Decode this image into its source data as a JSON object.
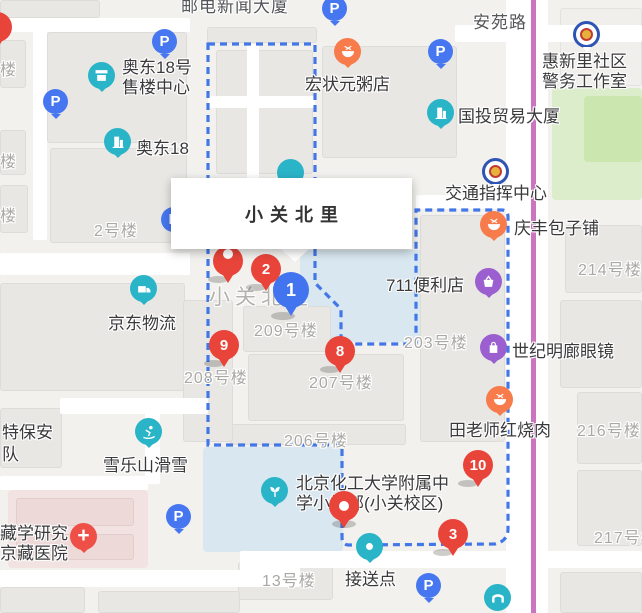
{
  "colors": {
    "marker_red": "#e8443a",
    "marker_blue": "#4374f0",
    "poi_teal": "#2ab4c8",
    "poi_orange": "#f87b4c",
    "poi_purple": "#9b5fd0",
    "parking_blue": "#4677f0",
    "boundary_blue": "#4377e8",
    "transit_magenta": "#cb74bf",
    "park_green": "#dcedcc",
    "school_blue": "#d9e7f0",
    "hospital_pink": "#f2e3e2"
  },
  "title_box": {
    "text": "小关北里"
  },
  "map_underlay_label": "小关北里",
  "road_labels": [
    "安苑路"
  ],
  "building_labels": [
    "邮电新闻大厦",
    "2号楼",
    "209号楼",
    "208号楼",
    "207号楼",
    "206号楼",
    "203号楼",
    "214号楼",
    "216号楼",
    "217号楼",
    "13号楼",
    "楼",
    "楼",
    "楼",
    "特保安",
    "队"
  ],
  "parking": {
    "letter": "P"
  },
  "markers": [
    {
      "number": "1",
      "color": "blue"
    },
    {
      "number": "2",
      "color": "red"
    },
    {
      "number": "3",
      "color": "red"
    },
    {
      "number": "8",
      "color": "red"
    },
    {
      "number": "9",
      "color": "red"
    },
    {
      "number": "10",
      "color": "red"
    },
    {
      "number": "",
      "color": "red"
    },
    {
      "number": "",
      "color": "red"
    }
  ],
  "pois": [
    {
      "label": "奥东18号",
      "label2": "售楼中心",
      "icon": "storefront"
    },
    {
      "label": "奥东18",
      "icon": "office-building"
    },
    {
      "label": "宏状元粥店",
      "icon": "food-bowl"
    },
    {
      "label": "国投贸易大厦",
      "icon": "office-building"
    },
    {
      "label": "惠新里社区",
      "label2": "警务工作室",
      "icon": "police-badge"
    },
    {
      "label": "交通指挥中心",
      "icon": "police-badge"
    },
    {
      "label": "庆丰包子铺",
      "icon": "food-bowl"
    },
    {
      "label": "711便利店",
      "icon": "shopping-basket"
    },
    {
      "label": "世纪明廊眼镜",
      "icon": "shopping-bag"
    },
    {
      "label": "田老师红烧肉",
      "icon": "food-bowl"
    },
    {
      "label": "京东物流",
      "icon": "delivery-truck"
    },
    {
      "label": "雪乐山滑雪",
      "icon": "skier"
    },
    {
      "label": "藏学研究",
      "label2": "京藏医院",
      "icon": "hospital-cross"
    },
    {
      "label": "接送点",
      "icon": "pickup-dot"
    },
    {
      "label": "北京化工大学附属中",
      "label2": "学小学部(小关校区)",
      "icon": "school-sprout"
    }
  ]
}
